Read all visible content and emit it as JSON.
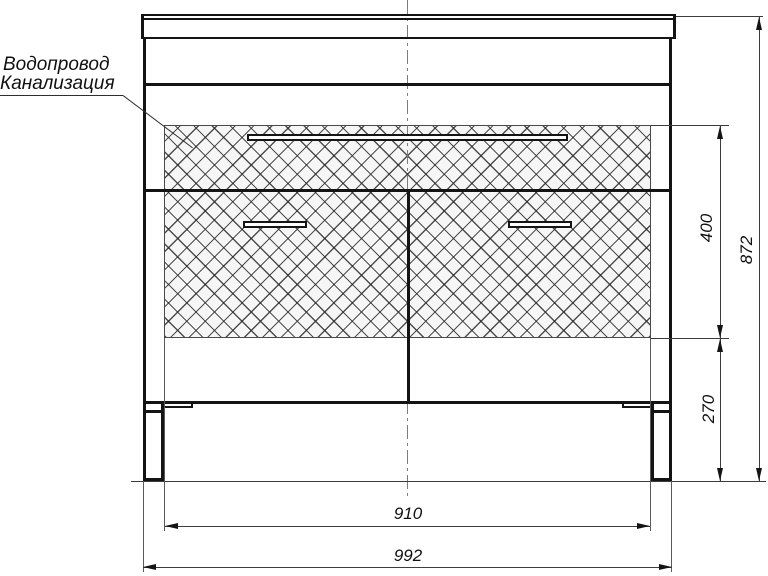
{
  "drawing": {
    "callout": {
      "line1": "Водопровод",
      "line2": "Канализация"
    },
    "dimensions": {
      "service_zone_height": "400",
      "overall_height": "872",
      "plinth_zone_height": "270",
      "inner_width": "910",
      "overall_width": "992"
    },
    "colors": {
      "outline": "#141414",
      "thin_line": "#3c3c3c",
      "centerline": "#7d7d7d",
      "hatch_line": "#232323",
      "hatch_background": "#f6f6f6",
      "background": "#ffffff"
    }
  }
}
